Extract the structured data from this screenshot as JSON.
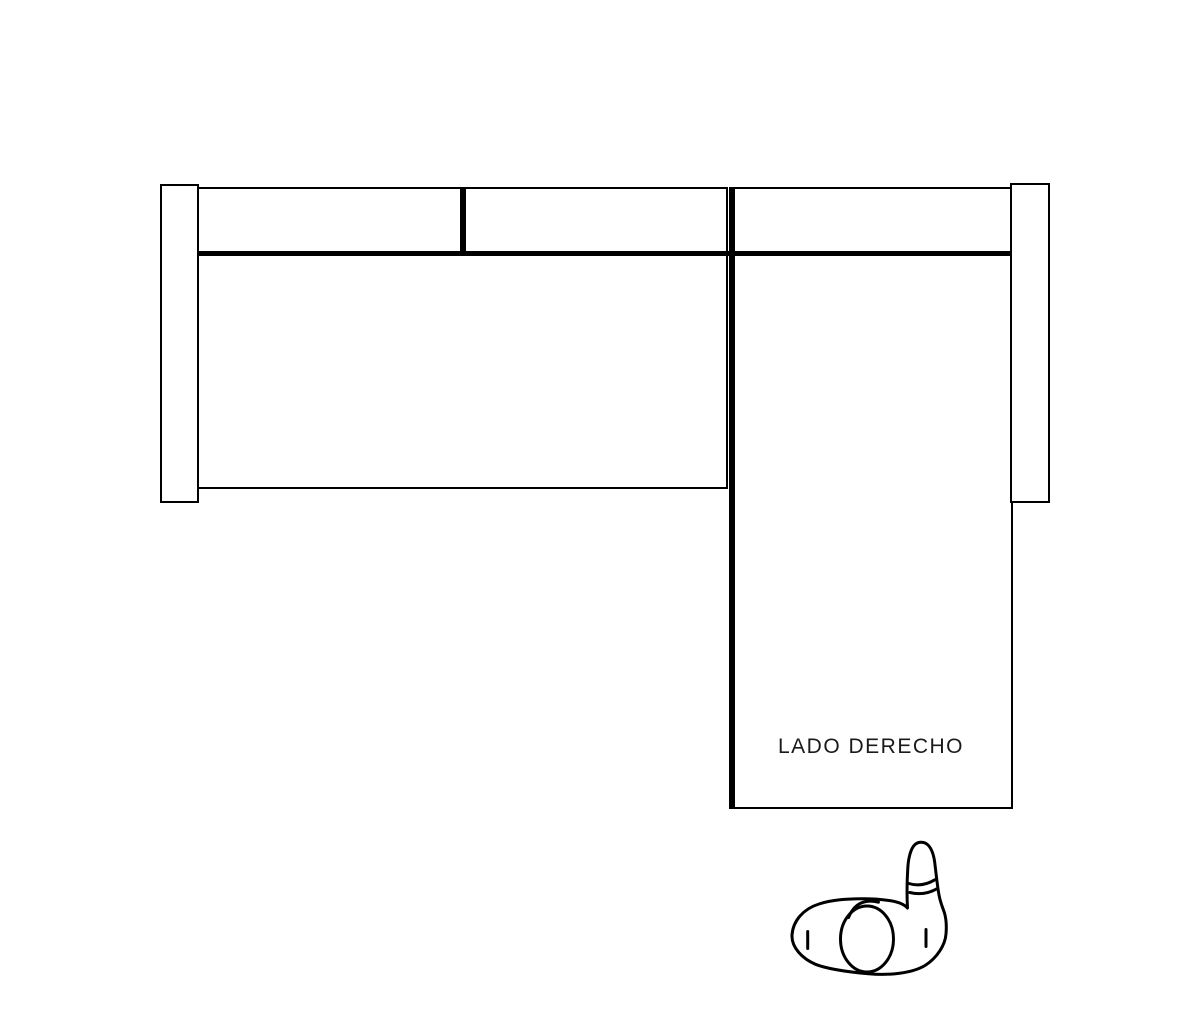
{
  "page": {
    "width_px": 1200,
    "height_px": 1028,
    "background": "#ffffff"
  },
  "diagram": {
    "chaise_label": "LADO DERECHO",
    "colors": {
      "line": "#000000",
      "fill": "#ffffff",
      "label_text": "#1a1a1a"
    },
    "icons": {
      "person": "person-top-view-icon"
    }
  }
}
